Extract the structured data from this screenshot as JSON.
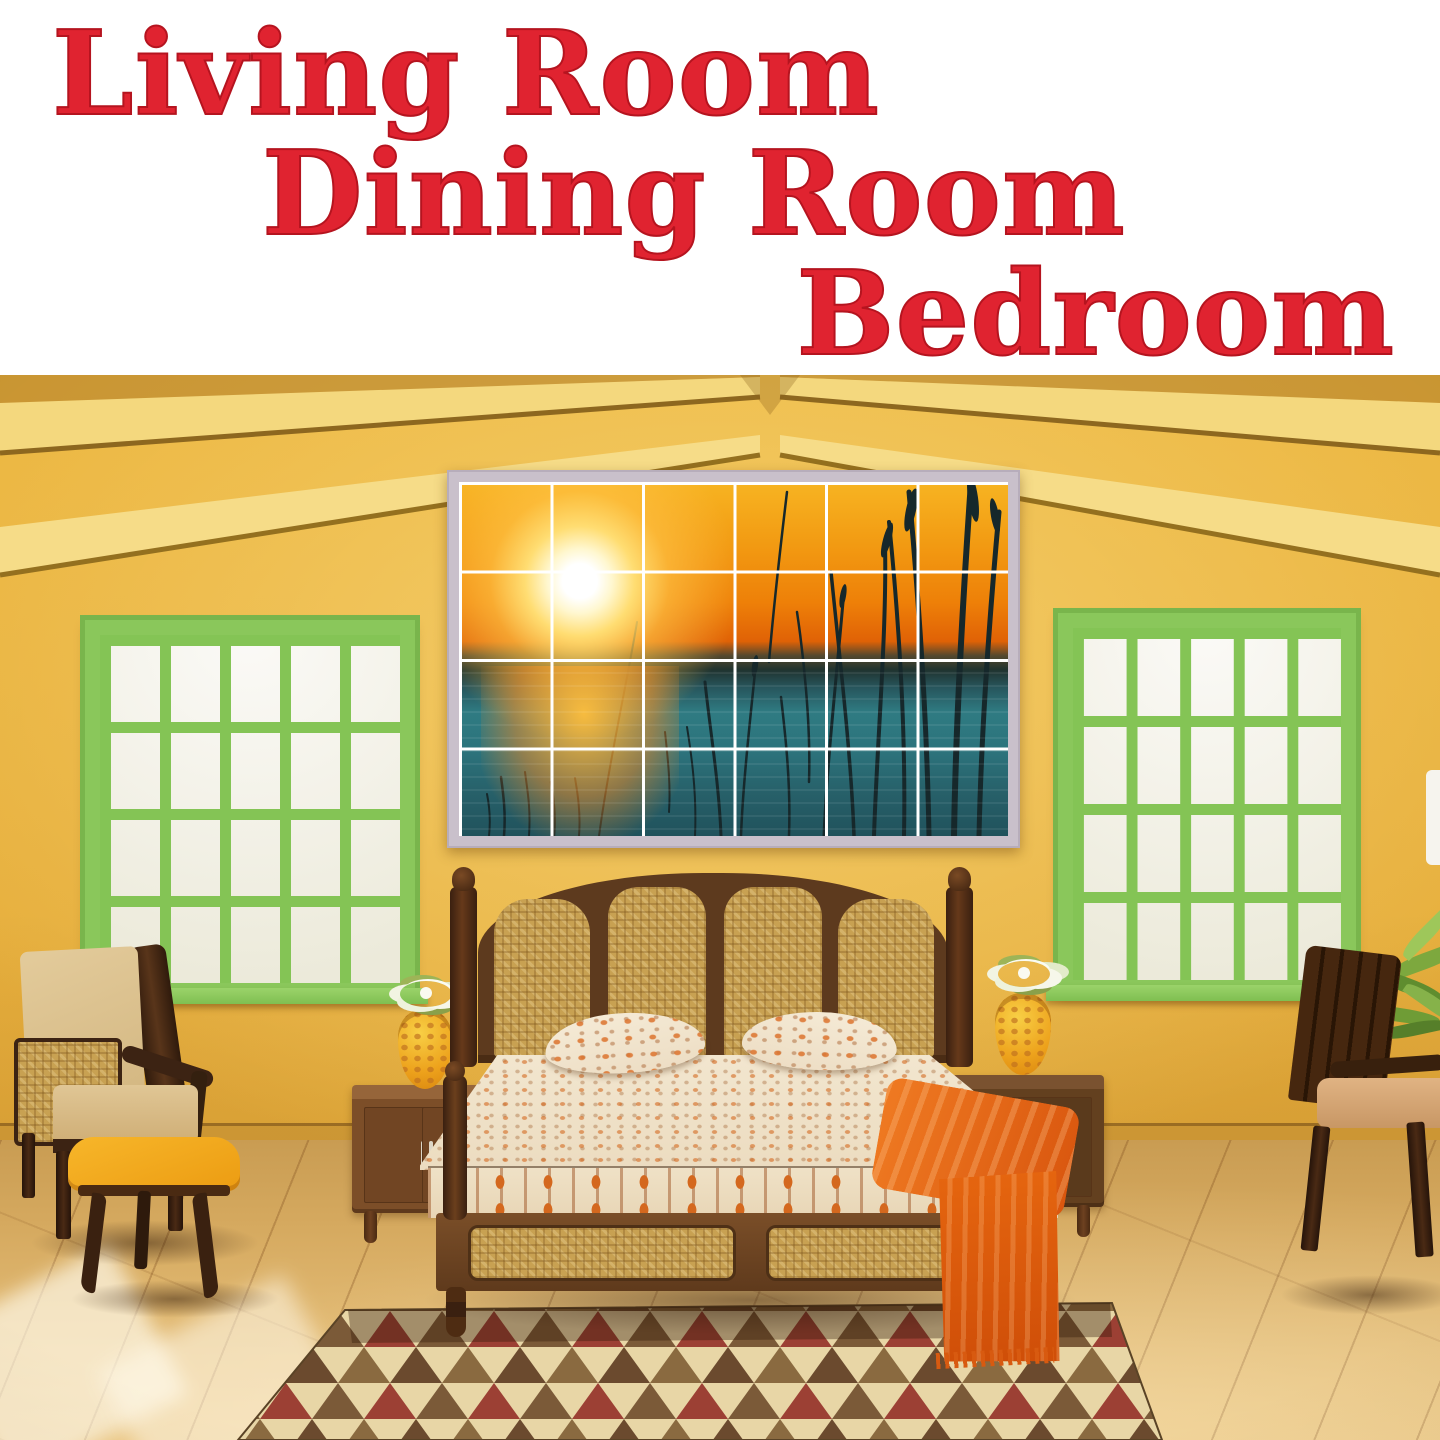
{
  "banner": {
    "background": "#ffffff",
    "text_color": "#e02330",
    "lines": [
      "Living Room",
      "Dining Room",
      "Bedroom"
    ]
  },
  "palette": {
    "wall": "#e6ae3c",
    "roof_beam": "#f4d87e",
    "window_frame": "#8ac75b",
    "window_pane": "#f2f1ec",
    "mural_frame": "#c9c0cb",
    "mural_sky_orange": "#ee8008",
    "mural_water_teal": "#2f7b82",
    "sun": "#fff7cf",
    "reeds": "#16282b",
    "bed_wood": "#5d3a1e",
    "cane": "#c8a152",
    "bedding_base": "#f0e3cb",
    "bedding_accent": "#d4681e",
    "throw_orange": "#e5650f",
    "nightstand_wood": "#7c4e28",
    "armchair_upholstery": "#d9bf8e",
    "footstool_yellow": "#f2a619",
    "floor_wood": "#d9ad63",
    "rug_base": "#e8d6a6",
    "rug_triangle_brown": "#7b5a38",
    "rug_triangle_red": "#9c4034",
    "rug_triangle_olive": "#8a6a40"
  },
  "scene": {
    "mural_grid": {
      "columns": 6,
      "rows": 4
    },
    "window_grid": {
      "columns": 5,
      "rows": 4
    }
  }
}
